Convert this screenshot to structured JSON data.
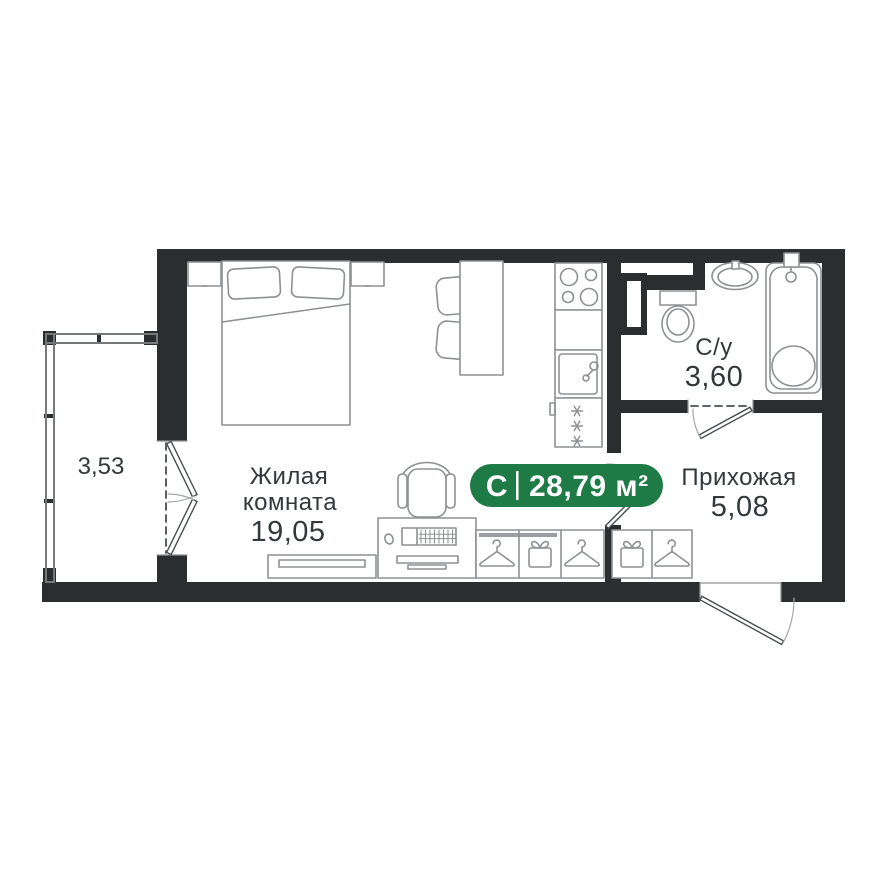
{
  "plan": {
    "badge": {
      "type_label": "С",
      "area": "28,79 м²"
    },
    "rooms": {
      "living": {
        "name_line1": "Жилая",
        "name_line2": "комната",
        "area": "19,05"
      },
      "bathroom": {
        "name": "С/у",
        "area": "3,60"
      },
      "hallway": {
        "name": "Прихожая",
        "area": "5,08"
      },
      "balcony": {
        "area": "3,53"
      }
    },
    "icons": [
      "hanger-icon",
      "storage-box-icon",
      "stove-burners-icon",
      "laundry-snowflake-icon"
    ],
    "colors": {
      "wall": "#2a2e2f",
      "fixture": "#8e9192",
      "glazing": "#75797a",
      "door": "#4a4f50",
      "label": "#33383a",
      "badge_green": "#1e7b46",
      "badge_text": "#ffffff",
      "background": "#ffffff"
    }
  }
}
